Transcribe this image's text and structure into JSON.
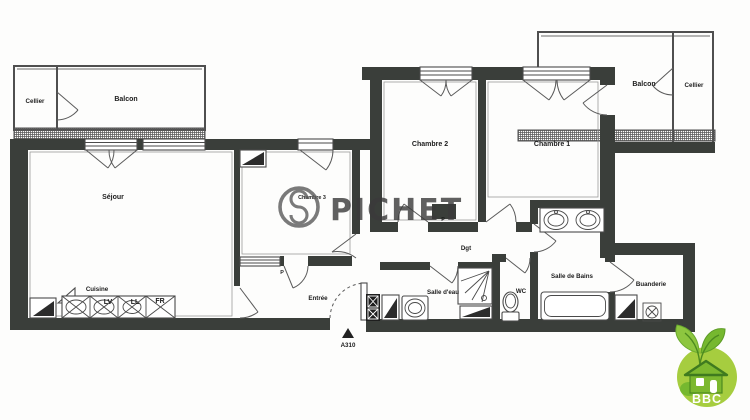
{
  "rooms": {
    "cellier_left": "Cellier",
    "balcon_left": "Balcon",
    "sejour": "Séjour",
    "cuisine": "Cuisine",
    "chambre3": "Chambre 3",
    "entree": "Entrée",
    "chambre2": "Chambre 2",
    "chambre1": "Chambre 1",
    "dgt": "Dgt",
    "salle_eau": "Salle d'eau",
    "wc": "WC",
    "salle_bains": "Salle de Bains",
    "buanderie": "Buanderie",
    "balcon_right": "Balcon",
    "cellier_right": "Cellier"
  },
  "appliances": {
    "dishwasher": "LV",
    "washer": "LL",
    "fridge": "FR"
  },
  "closets": {
    "label": "P"
  },
  "markers": {
    "unit_ref": "A310"
  },
  "watermark": {
    "brand": "PICHET"
  },
  "logo": {
    "text": "BBC"
  },
  "colors": {
    "wall": "#3a3e3a",
    "watermark_gray": "#3a3a3a",
    "bbc_circle": "#a6cd3f",
    "bbc_house": "#7cb82f",
    "bbc_house_dark": "#3f7a1f"
  }
}
